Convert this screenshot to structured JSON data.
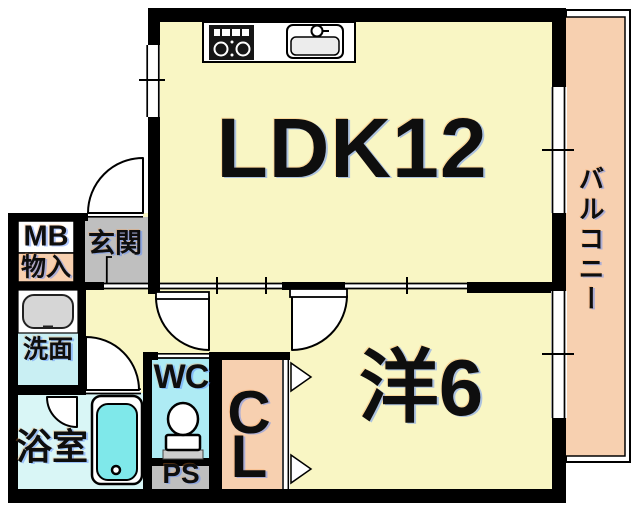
{
  "floorplan": {
    "rooms": {
      "ldk": {
        "label": "LDK12"
      },
      "western_room": {
        "label": "洋6"
      },
      "balcony": {
        "label": "バルコニー"
      },
      "entrance": {
        "label": "玄関"
      },
      "meter_box": {
        "label": "MB"
      },
      "storage": {
        "label": "物入"
      },
      "washroom": {
        "label": "洗面"
      },
      "bathroom": {
        "label": "浴室"
      },
      "toilet": {
        "label": "WC"
      },
      "pipe_space": {
        "label": "PS"
      },
      "closet": {
        "label": "CL"
      }
    },
    "colors": {
      "wall": "#000000",
      "yellow": "#f9f6c4",
      "peach": "#f7d0b0",
      "gray": "#bfbfbf",
      "washroom": "#c9eff3",
      "wc": "#aeebf4",
      "bath": "#d9f6f6",
      "tub": "#7fe8ea",
      "text": "#0e0e0e"
    },
    "icons": [
      "stove-icon",
      "kitchen-sink-icon",
      "washbasin-icon",
      "bathtub-icon",
      "toilet-icon",
      "door-swing-icon",
      "closet-door-icon",
      "window-icon"
    ]
  }
}
